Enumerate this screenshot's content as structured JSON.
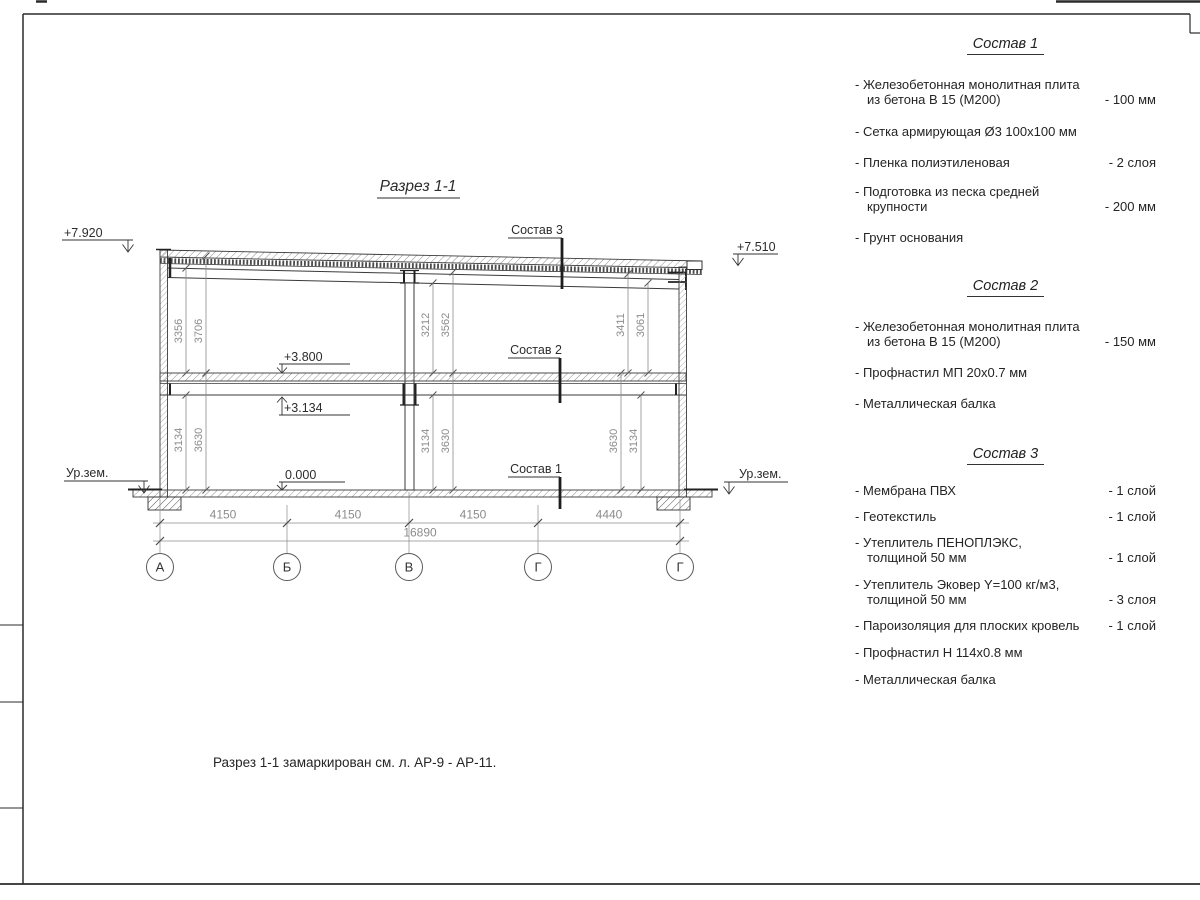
{
  "colors": {
    "ink": "#2e2e2e",
    "dim_gray": "#8c8c8c",
    "hatch": "#909090"
  },
  "drawing": {
    "title": "Разрез 1-1",
    "elevations": {
      "roof_left": "+7.920",
      "roof_right": "+7.510",
      "level2": "+3.800",
      "beam": "+3.134",
      "zero": "0.000",
      "ground_left": "Ур.зем.",
      "ground_right": "Ур.зем."
    },
    "markers": {
      "m1": "Состав 1",
      "m2": "Состав 2",
      "m3": "Состав 3"
    },
    "vdims": {
      "ul_inner": "3356",
      "ul_outer": "3706",
      "um_inner": "3212",
      "um_outer": "3562",
      "ur_inner": "3411",
      "ur_outer": "3061",
      "ll_inner": "3134",
      "ll_outer": "3630",
      "lm_inner": "3134",
      "lm_outer": "3630",
      "lr_inner": "3630",
      "lr_outer": "3134"
    },
    "hdims": {
      "s1": "4150",
      "s2": "4150",
      "s3": "4150",
      "s4": "4440",
      "total": "16890"
    },
    "axes": [
      "А",
      "Б",
      "В",
      "Г",
      "Г"
    ],
    "note": "Разрез 1-1 замаркирован см. л. АР-9 - АР-11."
  },
  "compositions": [
    {
      "title": "Состав 1",
      "items": [
        {
          "name": "- Железобетонная  монолитная плита\nиз бетона В 15 (М200)",
          "value": "- 100 мм"
        },
        {
          "name": "- Сетка армирующая Ø3 100x100 мм",
          "value": ""
        },
        {
          "name": "- Пленка полиэтиленовая",
          "value": "-  2 слоя"
        },
        {
          "name": "- Подготовка из песка средней\nкрупности",
          "value": "- 200 мм"
        },
        {
          "name": "- Грунт основания",
          "value": ""
        }
      ]
    },
    {
      "title": "Состав 2",
      "items": [
        {
          "name": "- Железобетонная  монолитная плита\nиз бетона В 15 (М200)",
          "value": "- 150 мм"
        },
        {
          "name": "- Профнастил МП 20x0.7 мм",
          "value": ""
        },
        {
          "name": "- Металлическая балка",
          "value": ""
        }
      ]
    },
    {
      "title": "Состав 3",
      "items": [
        {
          "name": "- Мембрана ПВХ",
          "value": "- 1 слой"
        },
        {
          "name": "- Геотекстиль",
          "value": "- 1 слой"
        },
        {
          "name": "- Утеплитель ПЕНОПЛЭКС,\nтолщиной 50 мм",
          "value": "- 1 слой"
        },
        {
          "name": "- Утеплитель Эковер Y=100 кг/м3,\nтолщиной 50 мм",
          "value": "- 3 слоя"
        },
        {
          "name": "- Пароизоляция для плоских кровель",
          "value": "- 1 слой"
        },
        {
          "name": "- Профнастил Н 114x0.8 мм",
          "value": ""
        },
        {
          "name": "- Металлическая балка",
          "value": ""
        }
      ]
    }
  ]
}
